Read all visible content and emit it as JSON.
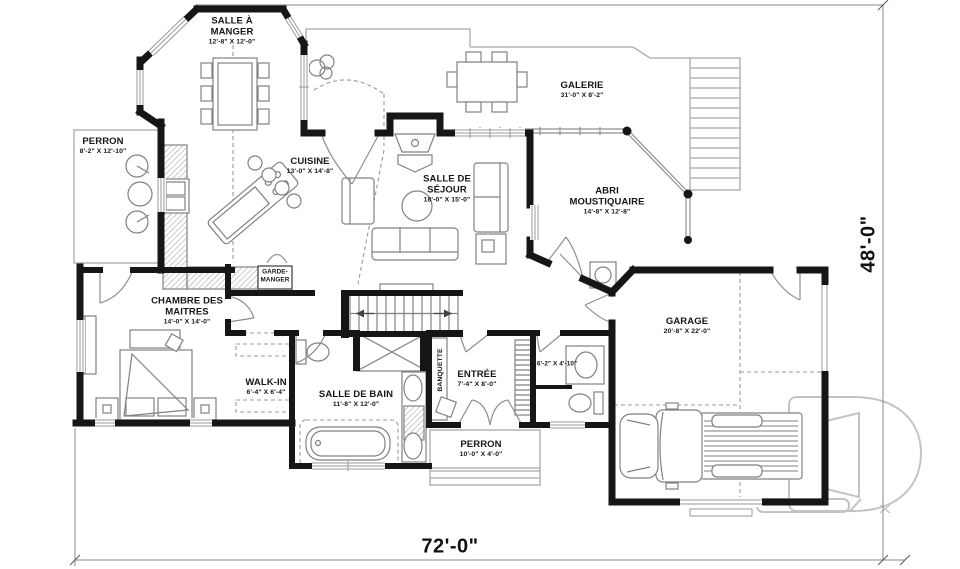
{
  "plan": {
    "type": "floor-plan",
    "rooms": [
      {
        "id": "salle-a-manger",
        "name": "SALLE À MANGER",
        "dims": "12'-8\" X 12'-0\""
      },
      {
        "id": "perron-upper",
        "name": "PERRON",
        "dims": "8'-2\" X 12'-10\""
      },
      {
        "id": "cuisine",
        "name": "CUISINE",
        "dims": "13'-0\" X 14'-8\""
      },
      {
        "id": "salle-de-sejour",
        "name": "SALLE DE SÉJOUR",
        "dims": "18'-0\" X 15'-0\""
      },
      {
        "id": "galerie",
        "name": "GALERIE",
        "dims": "31'-0\" X 8'-2\""
      },
      {
        "id": "abri-moustiquaire",
        "name": "ABRI MOUSTIQUAIRE",
        "dims": "14'-8\" X 12'-8\""
      },
      {
        "id": "garde-manger",
        "name": "GARDE-MANGER",
        "dims": ""
      },
      {
        "id": "chambre-des-maitres",
        "name": "CHAMBRE DES MAITRES",
        "dims": "14'-0\" X 14'-0\""
      },
      {
        "id": "walk-in",
        "name": "WALK-IN",
        "dims": "6'-4\" X 6'-4\""
      },
      {
        "id": "salle-de-bain",
        "name": "SALLE DE BAIN",
        "dims": "11'-8\" X 12'-0\""
      },
      {
        "id": "banquette",
        "name": "BANQUETTE",
        "dims": ""
      },
      {
        "id": "entree",
        "name": "ENTRÉE",
        "dims": "7'-4\" X 8'-0\""
      },
      {
        "id": "salle-eau",
        "name": "",
        "dims": "6'-2\" X 4'-10\""
      },
      {
        "id": "perron-lower",
        "name": "PERRON",
        "dims": "10'-0\" X 4'-0\""
      },
      {
        "id": "garage",
        "name": "GARAGE",
        "dims": "20'-8\" X 22'-0\""
      }
    ],
    "overall_dimensions": {
      "width": "72'-0\"",
      "height": "48'-0\""
    },
    "colors": {
      "wall": "#161616",
      "thin_line": "#8f8f8f",
      "watermark": "#c3c3c3"
    }
  }
}
